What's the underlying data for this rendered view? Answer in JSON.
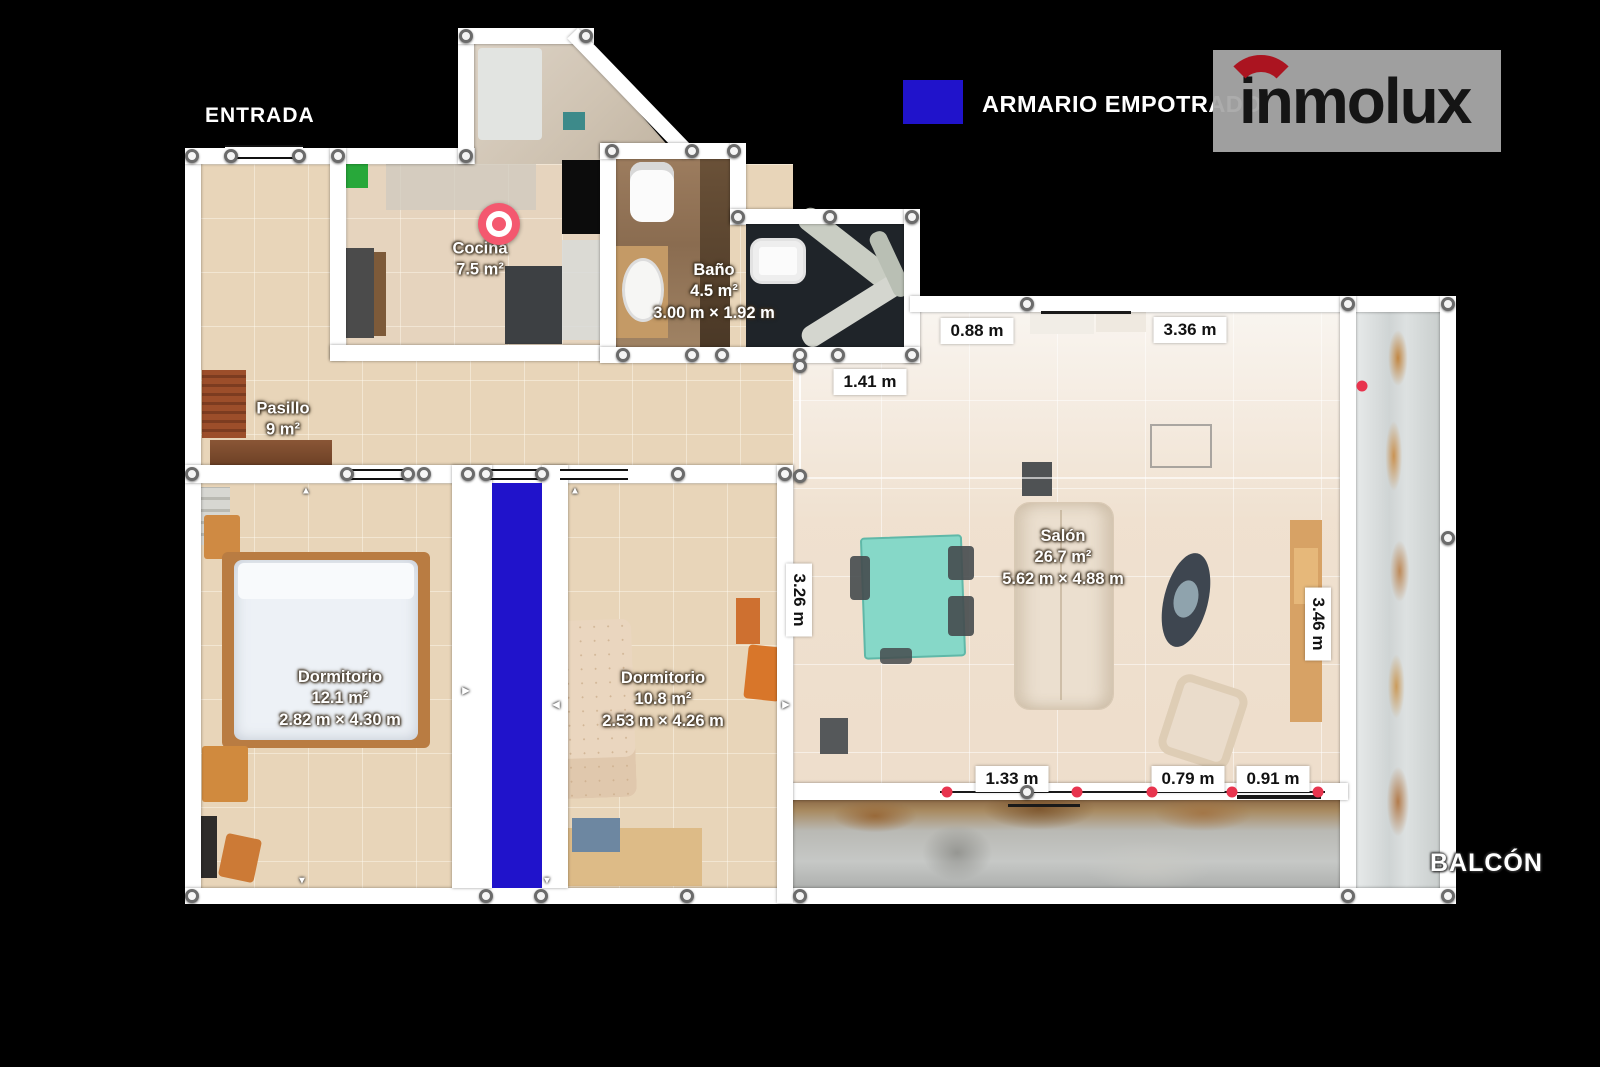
{
  "entrance_label": "ENTRADA",
  "balcony_label": "BALCÓN",
  "legend": {
    "label": "ARMARIO EMPOTRADO",
    "swatch_color": "#2013cb"
  },
  "logo": {
    "text": "inmolux",
    "arc_color": "#ab1420"
  },
  "rooms": {
    "cocina": {
      "name": "Cocina",
      "area": "7.5 m²"
    },
    "banio": {
      "name": "Baño",
      "area": "4.5 m²",
      "dimensions": "3.00 m × 1.92 m"
    },
    "pasillo": {
      "name": "Pasillo",
      "area": "9 m²"
    },
    "dormitorio1": {
      "name": "Dormitorio",
      "area": "12.1 m²",
      "dimensions": "2.82 m × 4.30 m"
    },
    "dormitorio2": {
      "name": "Dormitorio",
      "area": "10.8 m²",
      "dimensions": "2.53 m × 4.26 m"
    },
    "salon": {
      "name": "Salón",
      "area": "26.7 m²",
      "dimensions": "5.62 m × 4.88 m"
    }
  },
  "measurements": {
    "salon_top_left": "0.88 m",
    "salon_top_right": "3.36 m",
    "banio_bottom": "1.41 m",
    "salon_left_vertical": "3.26 m",
    "salon_right_vertical": "3.46 m",
    "salon_bottom_left": "1.33 m",
    "salon_bottom_mid": "0.79 m",
    "salon_bottom_right": "0.91 m"
  },
  "colors": {
    "background": "#000000",
    "wall": "#ffffff",
    "floor_beige": "#e8d5b9",
    "armario_blue": "#2013cb",
    "marker_pink": "#f4586f",
    "red_dot": "#e8344e"
  }
}
